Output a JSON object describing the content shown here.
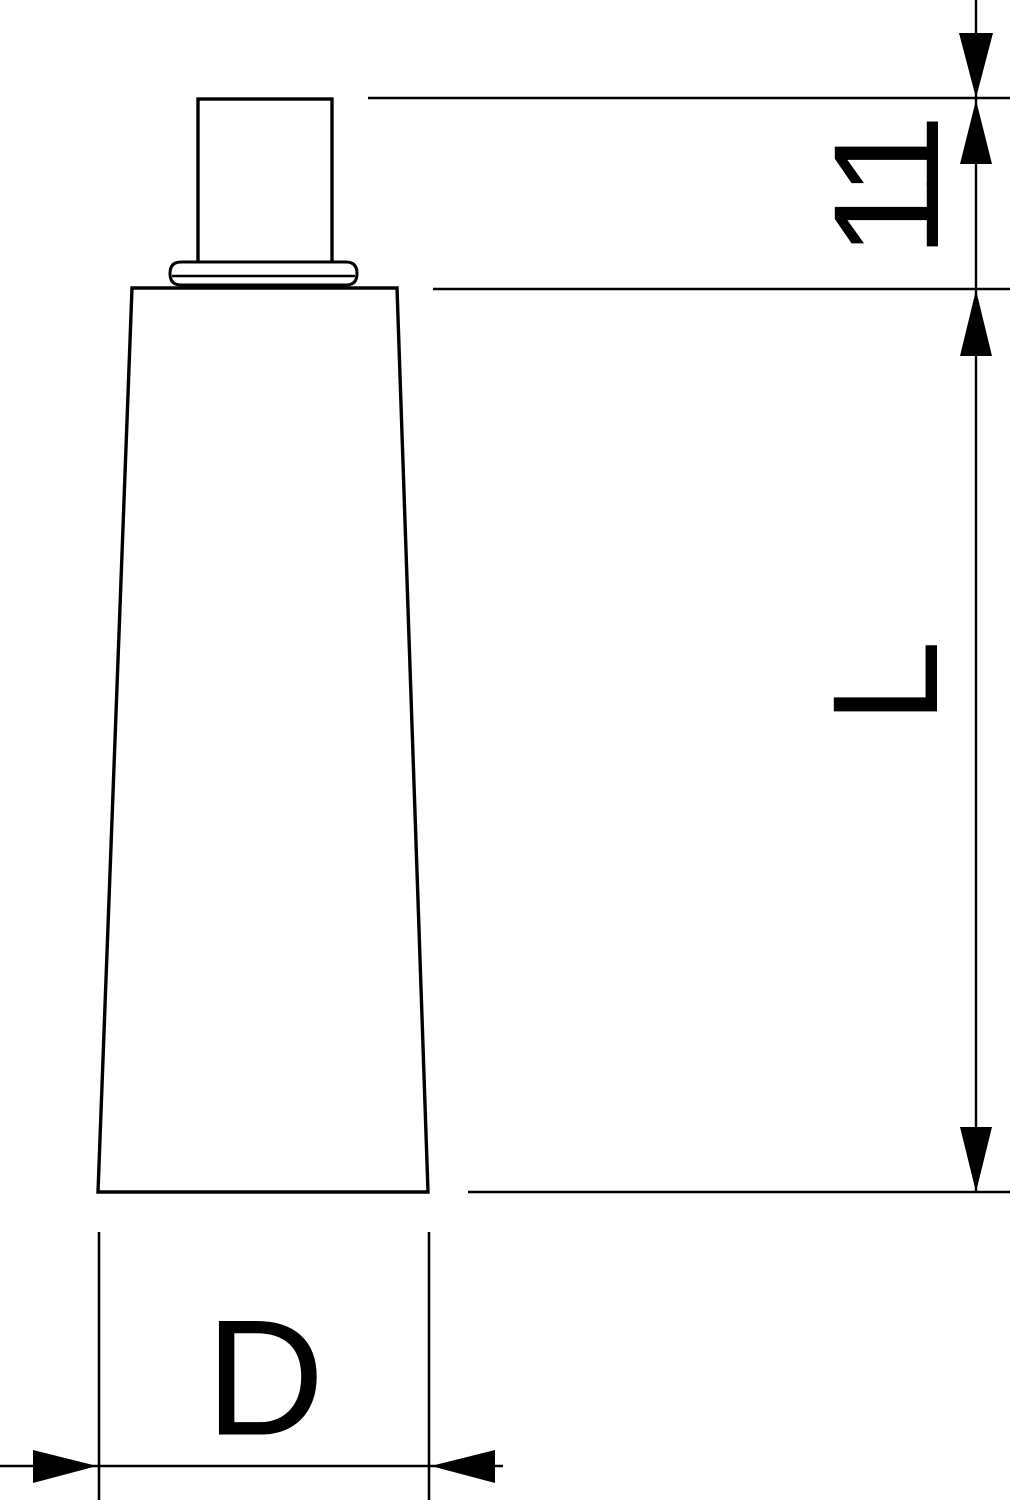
{
  "drawing": {
    "type": "technical-dimension-drawing",
    "subject": "tube (squeeze tube with nozzle cap), front view",
    "labels": {
      "cap_height": "11",
      "body_length": "L",
      "diameter": "D"
    },
    "dimensions": [
      {
        "label": "11",
        "measures": "cap/nozzle height",
        "orientation": "vertical",
        "side": "right"
      },
      {
        "label": "L",
        "measures": "tube body length",
        "orientation": "vertical",
        "side": "right"
      },
      {
        "label": "D",
        "measures": "tube bottom width / diameter",
        "orientation": "horizontal",
        "side": "bottom"
      }
    ],
    "colors": {
      "line": "#000000",
      "background": "#ffffff"
    }
  }
}
